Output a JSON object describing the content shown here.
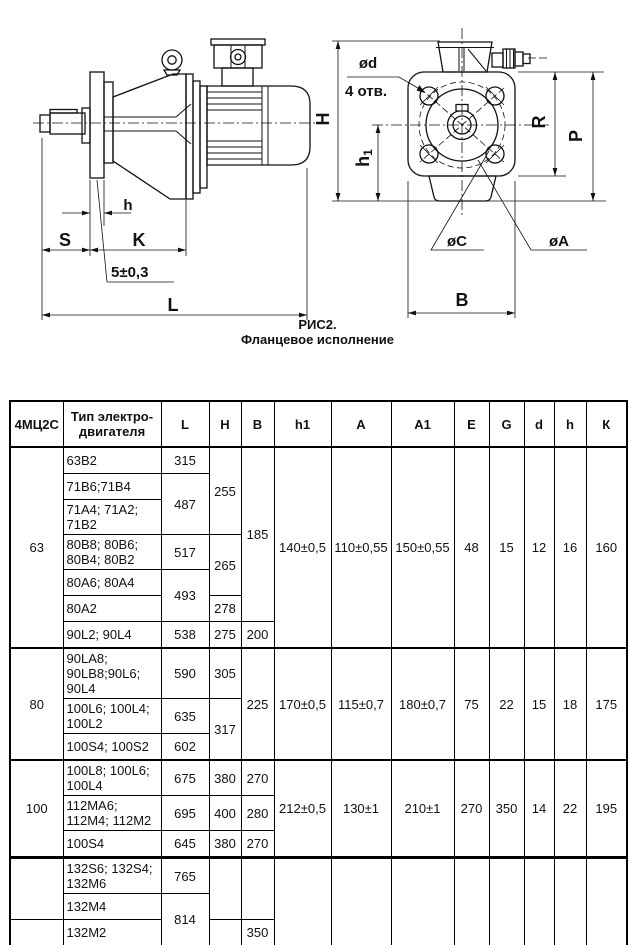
{
  "figure": {
    "caption": {
      "line1": "РИС2.",
      "line2": "Фланцевое исполнение"
    },
    "side_view": {
      "dim_h": "h",
      "dim_S": "S",
      "dim_K": "K",
      "dim_L": "L",
      "tolerance": "5±0,3"
    },
    "front_view": {
      "dim_d": "ød",
      "holes_note": "4 отв.",
      "dim_H": "H",
      "dim_h1_base": "h",
      "dim_h1_sub": "1",
      "dim_R": "R",
      "dim_P": "P",
      "dim_C": "øC",
      "dim_A": "øA",
      "dim_B": "B"
    }
  },
  "main_table": {
    "headers": [
      "4МЦ2С",
      "Тип электро-двигателя",
      "L",
      "H",
      "B",
      "h1",
      "A",
      "A1",
      "E",
      "G",
      "d",
      "h",
      "К"
    ],
    "groups": [
      {
        "size": "63",
        "rows": [
          {
            "motor": "63В2",
            "L": "315",
            "H": "255",
            "B": "185",
            "h1": "140±0,5",
            "A": "110±0,55",
            "A1": "150±0,55",
            "E": "48",
            "G": "15",
            "d": "12",
            "h": "16",
            "K": "160"
          },
          {
            "motor": "71В6;71В4",
            "L": "487"
          },
          {
            "motor": "71А4; 71А2;\n71В2"
          },
          {
            "motor": "80В8; 80В6;\n80В4; 80В2",
            "L": "517",
            "H": "265"
          },
          {
            "motor": "80А6; 80А4",
            "L": "493"
          },
          {
            "motor": "80А2",
            "H": "278"
          },
          {
            "motor": "90L2; 90L4",
            "L": "538",
            "H": "275",
            "B": "200"
          }
        ]
      },
      {
        "size": "80",
        "rows": [
          {
            "motor": "90LA8;\n90LB8;90L6;\n90L4",
            "L": "590",
            "H": "305",
            "B": "225",
            "h1": "170±0,5",
            "A": "115±0,7",
            "A1": "180±0,7",
            "E": "75",
            "G": "22",
            "d": "15",
            "h": "18",
            "K": "175"
          },
          {
            "motor": "100L6; 100L4;\n100L2",
            "L": "635",
            "H": "317"
          },
          {
            "motor": "100S4; 100S2",
            "L": "602"
          }
        ]
      },
      {
        "size": "100",
        "rows": [
          {
            "motor": "100L8; 100L6;\n100L4",
            "L": "675",
            "H": "380",
            "B": "270",
            "h1": "212±0,5",
            "A": "130±1",
            "A1": "210±1",
            "E": "270",
            "G": "350",
            "d": "14",
            "h": "22",
            "K": "195"
          },
          {
            "motor": "112MA6;\n112M4; 112M2",
            "L": "695",
            "H": "400",
            "B": "280"
          },
          {
            "motor": "100S4",
            "L": "645",
            "H": "380",
            "B": "270"
          }
        ]
      },
      {
        "size": "125",
        "rows": [
          {
            "motor": "112MA6;\n112MB6; 112M4",
            "L": "738",
            "H": "480",
            "B": "335",
            "h1": "265±1",
            "A": "160±0,7",
            "A1": "280±0,7",
            "E": "105",
            "G": "25",
            "d": "19",
            "h": "28",
            "K": "235"
          }
        ]
      }
    ]
  },
  "extra_table": {
    "rows": [
      {
        "motor": "132S6; 132S4;\n132M6",
        "L": "765"
      },
      {
        "motor": "132M4",
        "L": "814"
      },
      {
        "motor": "132M2",
        "B": "350"
      }
    ]
  }
}
